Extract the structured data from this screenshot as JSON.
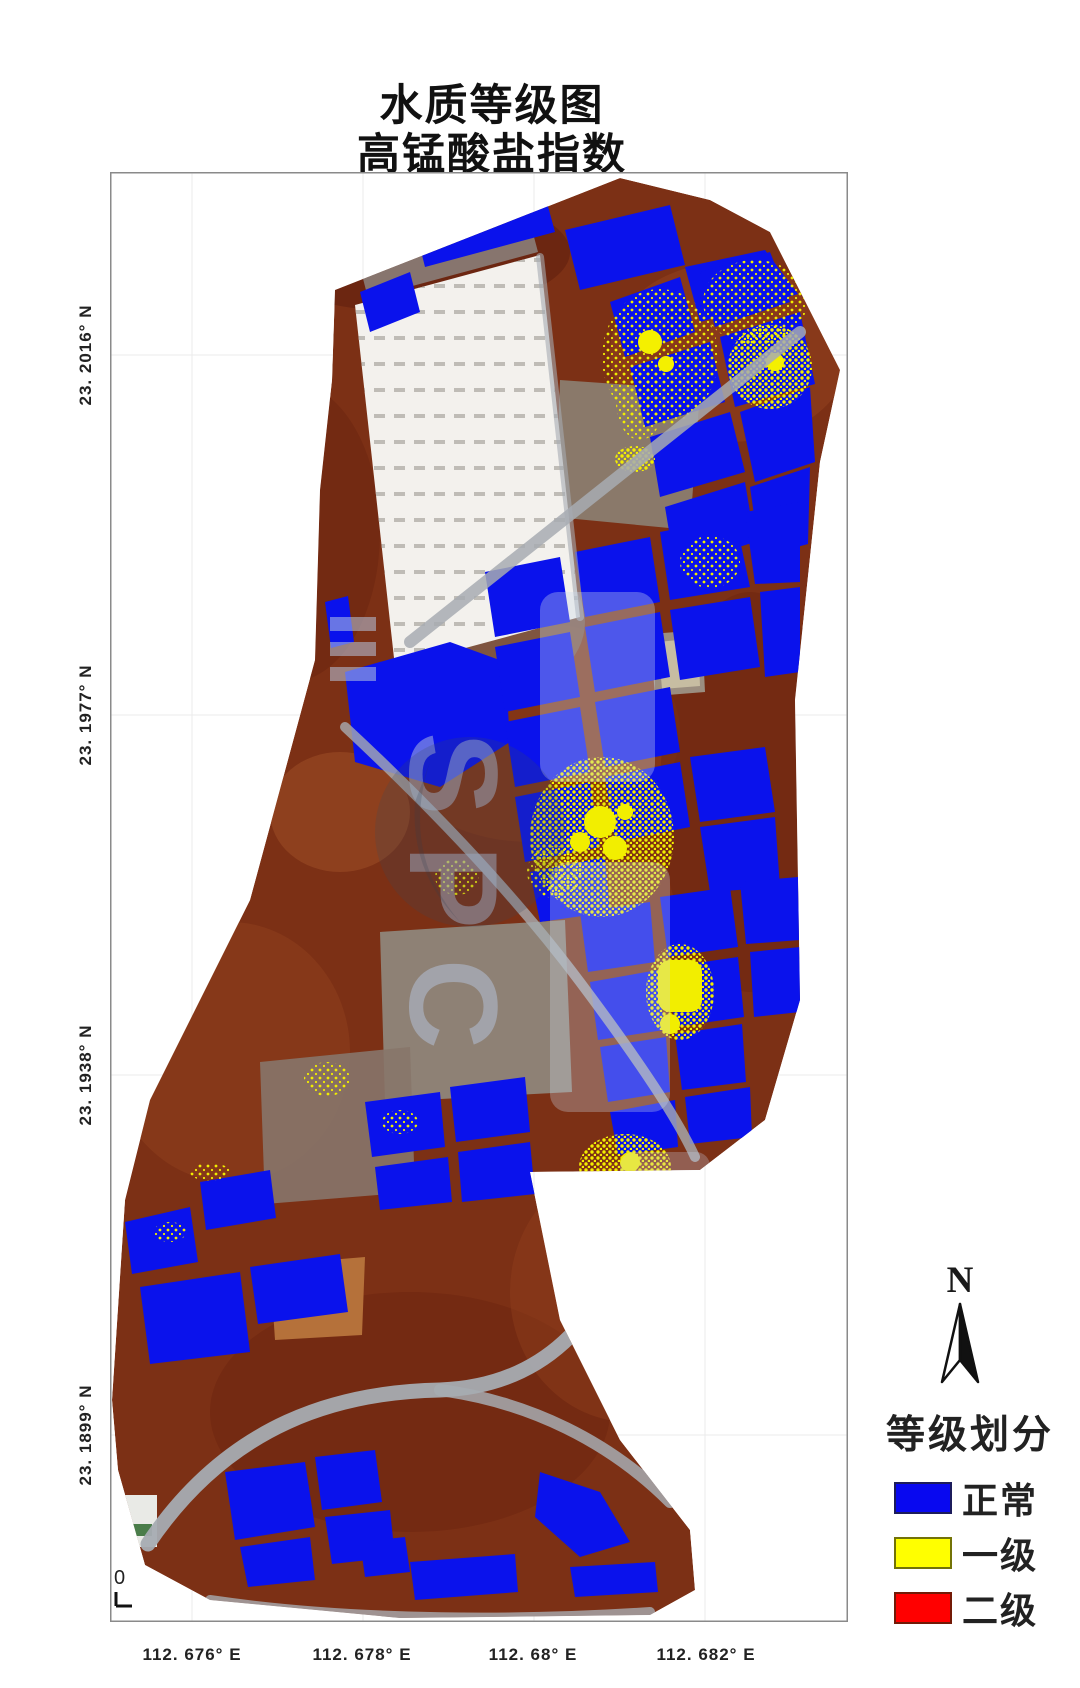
{
  "title": {
    "line1": "水质等级图",
    "line2": "高锰酸盐指数"
  },
  "axes": {
    "lat_labels": [
      "23. 2016° N",
      "23. 1977° N",
      "23. 1938° N",
      "23. 1899° N"
    ],
    "lon_labels": [
      "112. 676° E",
      "112. 678° E",
      "112. 68° E",
      "112. 682° E"
    ],
    "scale_zero": "0"
  },
  "compass": {
    "label": "N"
  },
  "legend": {
    "title": "等级划分",
    "items": [
      {
        "label": "正常",
        "color": "#0808F0"
      },
      {
        "label": "一级",
        "color": "#FFFF00"
      },
      {
        "label": "二级",
        "color": "#FF0000"
      }
    ]
  },
  "map_colors": {
    "pond_normal": "#0A12EC",
    "grade1_speckle": "#F2EE00",
    "dike_terrain": "#7C3015",
    "road_gray": "#A7ACB2",
    "drained_pond": "#8E8175",
    "greenhouse_white": "#F3F1ED"
  },
  "watermark": {
    "text": "SPC"
  }
}
